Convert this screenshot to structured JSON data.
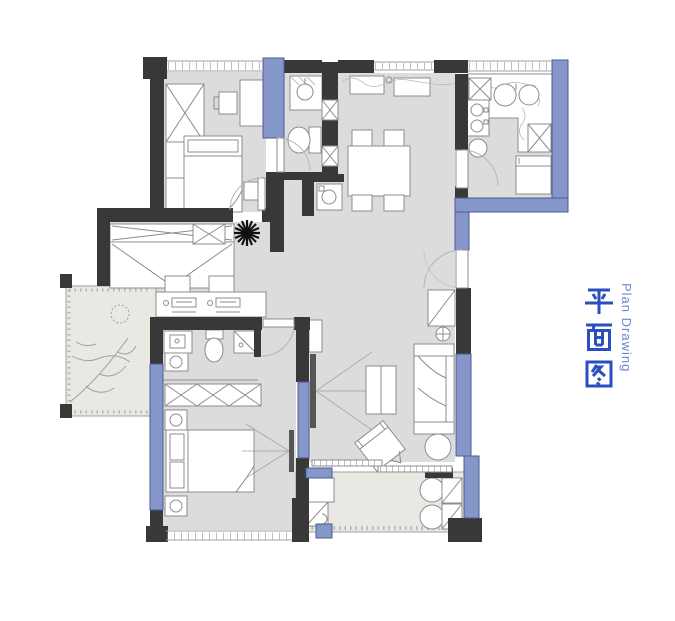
{
  "title_block": {
    "chinese": "平面图",
    "english": "Plan Drawing"
  },
  "palette": {
    "bg": "#ffffff",
    "wall": "#383838",
    "window": "#8496ca",
    "window_border": "#4d5c8e",
    "floor": "#dcdcdc",
    "balcony": "#eae8e3",
    "line": "#8c8c8c",
    "door": "#b5b5b5",
    "title_cn": "#2a4fbe",
    "title_en": "#6e85d6",
    "plant": "#111111"
  },
  "symbols": {
    "plant_icon": "starburst-plant",
    "tree_icon": "balcony-tree-branch",
    "duct_icon": "x-box-shaft",
    "window_icon": "blue-band",
    "door_icon": "quarter-arc-swing"
  }
}
